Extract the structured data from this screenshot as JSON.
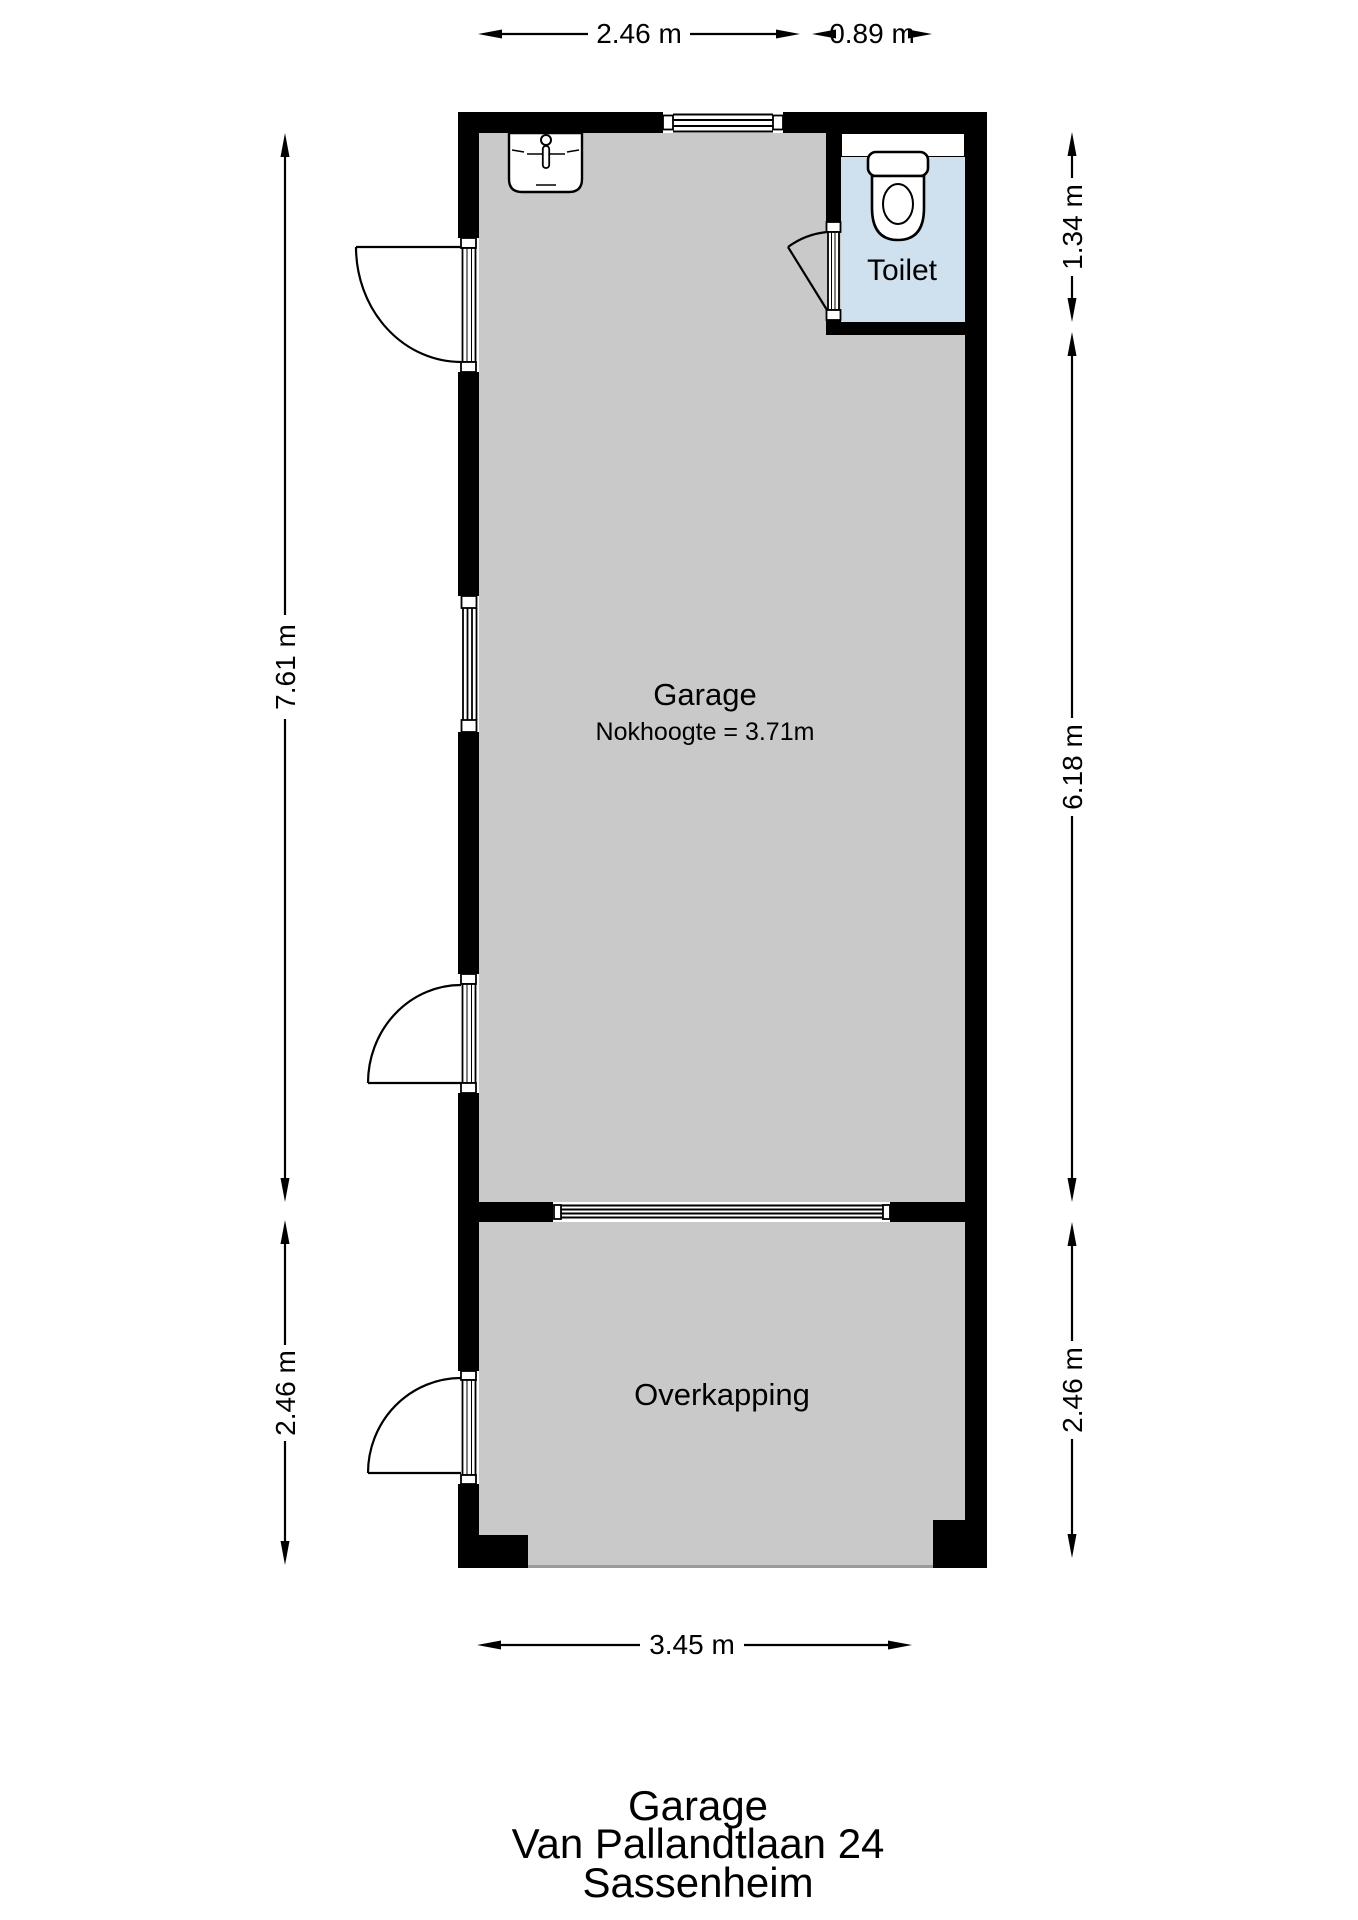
{
  "colors": {
    "floor": "#c9c9c9",
    "toilet-floor": "#cfe0ef",
    "wall": "#000000",
    "line": "#000000",
    "bg": "#ffffff",
    "floor-edge": "#9a9a9a"
  },
  "dims": {
    "top": [
      "2.46 m",
      "0.89 m"
    ],
    "left": [
      "7.61 m",
      "2.46 m"
    ],
    "right": [
      "1.34 m",
      "6.18 m",
      "2.46 m"
    ],
    "bottom": [
      "3.45 m"
    ]
  },
  "rooms": {
    "garage": {
      "label": "Garage",
      "note": "Nokhoogte = 3.71m"
    },
    "toilet": {
      "label": "Toilet"
    },
    "overkapping": {
      "label": "Overkapping"
    }
  },
  "footer": {
    "line1": "Garage",
    "line2": "Van Pallandtlaan 24",
    "line3": "Sassenheim"
  },
  "icons": {
    "sink": "sink-icon",
    "toilet": "toilet-icon"
  }
}
